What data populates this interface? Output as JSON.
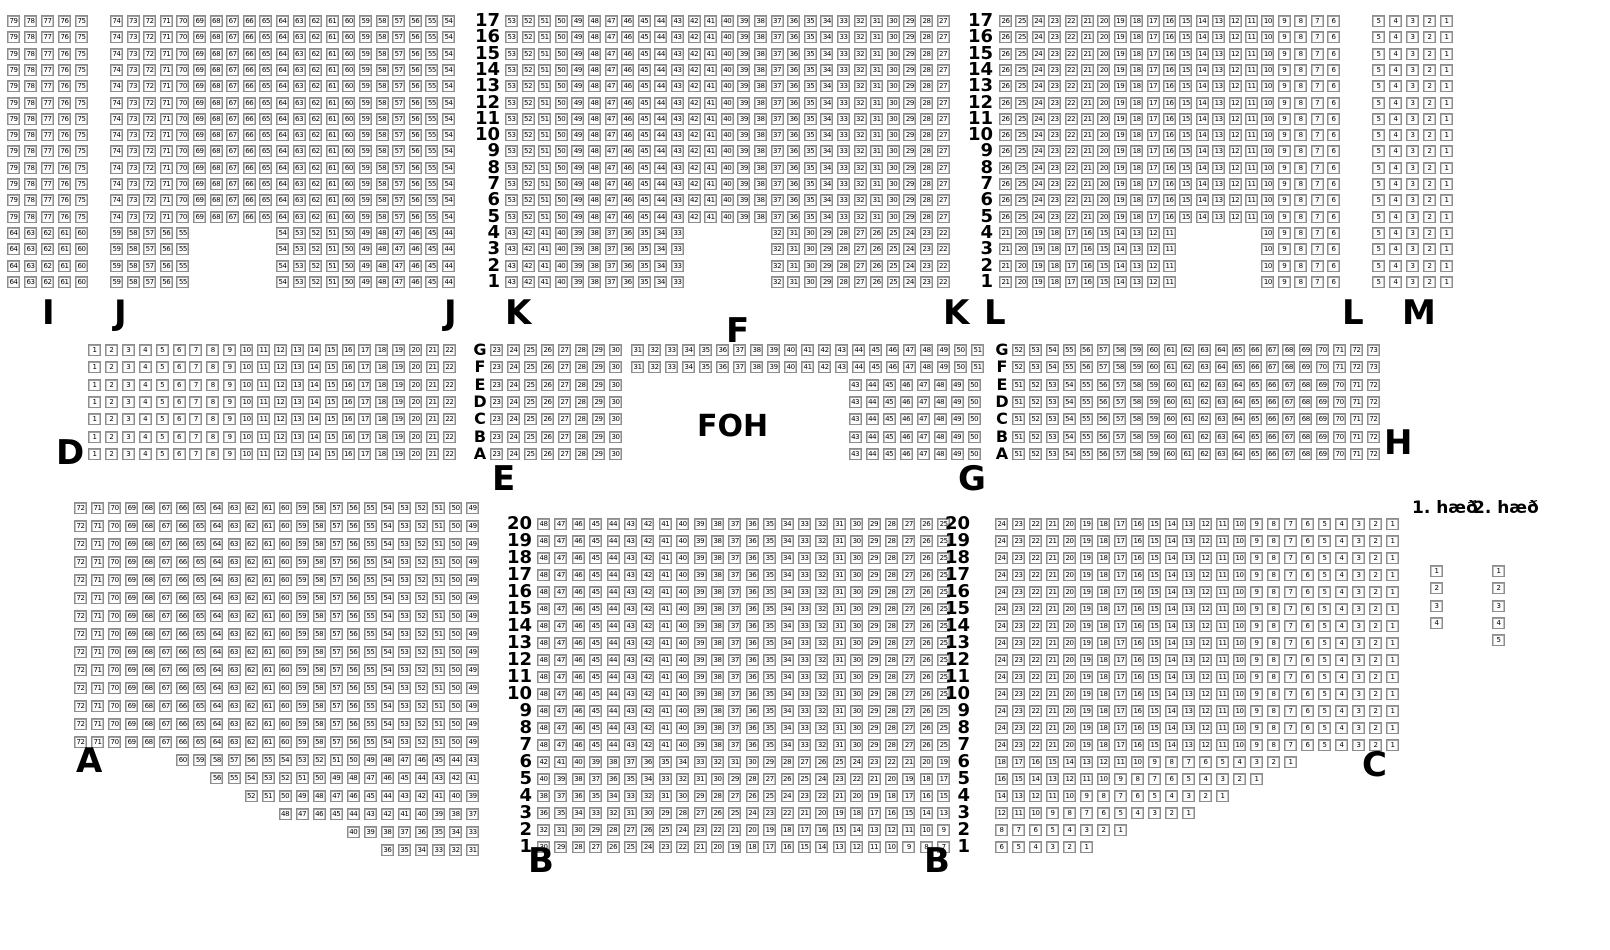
{
  "foh_label": "FOH",
  "legend": {
    "floor1_label": "1. hæð",
    "floor2_label": "2. hæð"
  },
  "section_labels": [
    {
      "text": "I",
      "x": 42,
      "y": 296
    },
    {
      "text": "J",
      "x": 114,
      "y": 296
    },
    {
      "text": "J",
      "x": 444,
      "y": 296
    },
    {
      "text": "K",
      "x": 505,
      "y": 296
    },
    {
      "text": "K",
      "x": 943,
      "y": 296
    },
    {
      "text": "L",
      "x": 984,
      "y": 296
    },
    {
      "text": "L",
      "x": 1342,
      "y": 296
    },
    {
      "text": "M",
      "x": 1402,
      "y": 296
    },
    {
      "text": "D",
      "x": 56,
      "y": 436
    },
    {
      "text": "E",
      "x": 492,
      "y": 462
    },
    {
      "text": "F",
      "x": 726,
      "y": 314
    },
    {
      "text": "G",
      "x": 958,
      "y": 462
    },
    {
      "text": "H",
      "x": 1384,
      "y": 426
    },
    {
      "text": "A",
      "x": 76,
      "y": 744
    },
    {
      "text": "B",
      "x": 528,
      "y": 844
    },
    {
      "text": "B",
      "x": 924,
      "y": 844
    },
    {
      "text": "C",
      "x": 1362,
      "y": 748
    }
  ],
  "row_number_columns": [
    {
      "xr": 500,
      "y": 15,
      "py": 16.3,
      "from": 17,
      "to": 1
    },
    {
      "xr": 993,
      "y": 15,
      "py": 16.3,
      "from": 17,
      "to": 1
    },
    {
      "xr": 532,
      "y": 518,
      "py": 17,
      "from": 20,
      "to": 1
    },
    {
      "xr": 970,
      "y": 518,
      "py": 17,
      "from": 20,
      "to": 1
    }
  ],
  "row_letter_columns": [
    {
      "x": 473,
      "y": 344,
      "py": 17.3,
      "letters": [
        "G",
        "F",
        "E",
        "D",
        "C",
        "B",
        "A"
      ]
    },
    {
      "x": 995,
      "y": 344,
      "py": 17.3,
      "letters": [
        "G",
        "F",
        "E",
        "D",
        "C",
        "B",
        "A"
      ]
    }
  ],
  "seat_blocks": [
    {
      "name": "I",
      "x": 7,
      "y": 15,
      "px": 17,
      "py": 16.3,
      "rows": [
        {
          "rep": 13,
          "segs": [
            [
              0,
              "79-75"
            ]
          ]
        },
        {
          "rep": 4,
          "segs": [
            [
              0,
              "64-60"
            ]
          ]
        }
      ]
    },
    {
      "name": "J",
      "x": 110,
      "y": 15,
      "px": 16.6,
      "py": 16.3,
      "rows": [
        {
          "rep": 13,
          "segs": [
            [
              0,
              "74-54"
            ]
          ]
        },
        {
          "rep": 4,
          "segs": [
            [
              0,
              "59-55"
            ],
            [
              10,
              "54-44"
            ]
          ]
        }
      ]
    },
    {
      "name": "K",
      "x": 505,
      "y": 15,
      "px": 16.6,
      "py": 16.3,
      "rows": [
        {
          "rep": 13,
          "segs": [
            [
              0,
              "53-27"
            ]
          ]
        },
        {
          "rep": 4,
          "segs": [
            [
              0,
              "43-33"
            ],
            [
              16,
              "32-22"
            ]
          ]
        }
      ]
    },
    {
      "name": "L",
      "x": 999,
      "y": 15,
      "px": 16.4,
      "py": 16.3,
      "rows": [
        {
          "rep": 13,
          "segs": [
            [
              0,
              "26-6"
            ]
          ]
        },
        {
          "rep": 4,
          "segs": [
            [
              0,
              "21-11"
            ],
            [
              16,
              "10-6"
            ]
          ]
        }
      ]
    },
    {
      "name": "M",
      "x": 1372,
      "y": 15,
      "px": 17,
      "py": 16.3,
      "rows": [
        {
          "rep": 17,
          "segs": [
            [
              0,
              "5-1"
            ]
          ]
        }
      ]
    },
    {
      "name": "D",
      "x": 88,
      "y": 344,
      "px": 16.9,
      "py": 17.3,
      "rows": [
        {
          "rep": 7,
          "segs": [
            [
              0,
              "1-22"
            ]
          ]
        }
      ]
    },
    {
      "name": "E",
      "x": 490,
      "y": 344,
      "px": 17,
      "py": 17.3,
      "rows": [
        {
          "rep": 2,
          "segs": [
            [
              0,
              "23-30"
            ],
            [
              8.3,
              "31-51"
            ]
          ]
        },
        {
          "rep": 5,
          "segs": [
            [
              0,
              "23-30"
            ],
            [
              21.1,
              "43-50"
            ]
          ]
        }
      ]
    },
    {
      "name": "H",
      "x": 1012,
      "y": 344,
      "px": 16.9,
      "py": 17.3,
      "rows": [
        {
          "rep": 2,
          "segs": [
            [
              0,
              "52-73"
            ]
          ]
        },
        {
          "rep": 5,
          "segs": [
            [
              0,
              "51-72"
            ]
          ]
        }
      ]
    },
    {
      "name": "A",
      "x": 74,
      "y": 502,
      "px": 17.05,
      "py": 18,
      "rows": [
        {
          "rep": 14,
          "segs": [
            [
              0,
              "72-49"
            ]
          ]
        },
        {
          "segs": [
            [
              6,
              "60-43"
            ]
          ]
        },
        {
          "segs": [
            [
              8,
              "56-41"
            ]
          ]
        },
        {
          "segs": [
            [
              10,
              "52-39"
            ]
          ]
        },
        {
          "segs": [
            [
              12,
              "48-37"
            ]
          ]
        },
        {
          "segs": [
            [
              16,
              "40-33"
            ]
          ]
        },
        {
          "segs": [
            [
              18,
              "36-31"
            ]
          ]
        }
      ]
    },
    {
      "name": "B",
      "x": 537,
      "y": 518,
      "px": 17.4,
      "py": 17,
      "rows": [
        {
          "rep": 14,
          "segs": [
            [
              0,
              "48-25"
            ]
          ]
        },
        {
          "segs": [
            [
              0,
              "42-19"
            ]
          ]
        },
        {
          "segs": [
            [
              0,
              "40-17"
            ]
          ]
        },
        {
          "segs": [
            [
              0,
              "38-15"
            ]
          ]
        },
        {
          "segs": [
            [
              0,
              "36-13"
            ]
          ]
        },
        {
          "segs": [
            [
              0,
              "32-9"
            ]
          ]
        },
        {
          "segs": [
            [
              0,
              "30-7"
            ]
          ]
        }
      ]
    },
    {
      "name": "C",
      "x": 995,
      "y": 518,
      "px": 17,
      "py": 17,
      "rows": [
        {
          "rep": 14,
          "segs": [
            [
              0,
              "24-1"
            ]
          ]
        },
        {
          "segs": [
            [
              0,
              "18-1"
            ]
          ]
        },
        {
          "segs": [
            [
              0,
              "16-1"
            ]
          ]
        },
        {
          "segs": [
            [
              0,
              "14-1"
            ]
          ]
        },
        {
          "segs": [
            [
              0,
              "12-1"
            ]
          ]
        },
        {
          "segs": [
            [
              0,
              "8-1"
            ]
          ]
        },
        {
          "segs": [
            [
              0,
              "6-1"
            ]
          ]
        }
      ]
    },
    {
      "name": "floor1",
      "x": 1430,
      "y": 565,
      "px": 17,
      "py": 17.3,
      "rows": [
        {
          "segs": [
            [
              0,
              "1"
            ]
          ]
        },
        {
          "segs": [
            [
              0,
              "2"
            ]
          ]
        },
        {
          "segs": [
            [
              0,
              "3"
            ]
          ]
        },
        {
          "segs": [
            [
              0,
              "4"
            ]
          ]
        }
      ]
    },
    {
      "name": "floor2",
      "x": 1492,
      "y": 565,
      "px": 17,
      "py": 17.3,
      "rows": [
        {
          "segs": [
            [
              0,
              "1"
            ]
          ]
        },
        {
          "segs": [
            [
              0,
              "2"
            ]
          ]
        },
        {
          "segs": [
            [
              0,
              "3"
            ]
          ]
        },
        {
          "segs": [
            [
              0,
              "4"
            ]
          ]
        },
        {
          "segs": [
            [
              0,
              "5"
            ]
          ]
        }
      ]
    }
  ]
}
